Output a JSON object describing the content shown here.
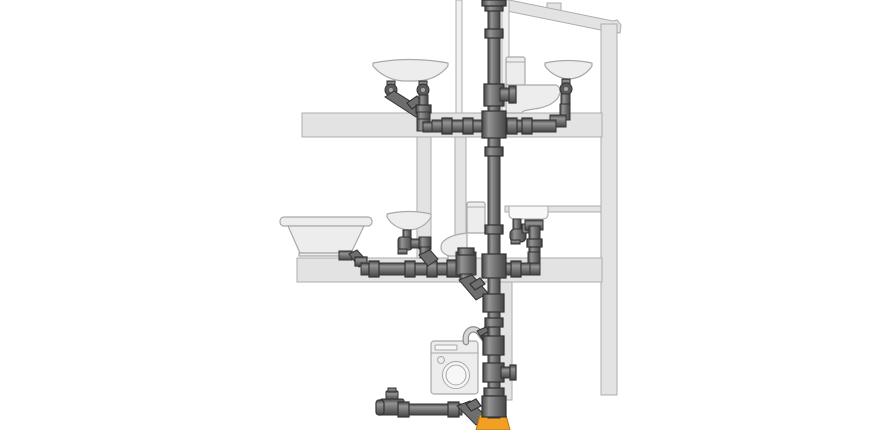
{
  "diagram": {
    "type": "building-drainage-cross-section",
    "floors": 3
  },
  "colors": {
    "background": "#ffffff",
    "structure": "#e3e3e3",
    "structure_stroke": "#aeaeae",
    "wall_light": "#f1f1f1",
    "fixture": "#ededed",
    "fixture_light": "#f7f7f7",
    "fixture_stroke": "#a9a9a9",
    "pipe_dark": "#474747",
    "pipe_mid": "#6e6e6e",
    "pipe_light": "#949494",
    "pipe_stroke": "#333333",
    "joint": "#5a5a5a",
    "joint_highlight": "#a6a6a6",
    "hose": "#d6d6d6",
    "hose_outline": "#8f8f8f",
    "sewer_orange": "#f2a024"
  },
  "labels": {
    "diagram": "Drainage system cross-section of a building",
    "roof": "Sloped roof",
    "right_wall": "Exterior wall",
    "upper_slab": "Upper floor slab",
    "middle_slab": "Lower floor slab",
    "attic_partition": "Attic partition wall",
    "attic_shaft": "Attic pipe shaft wall",
    "bathroom_wall": "Bathroom partition wall",
    "toilet_wall": "Toilet partition wall",
    "lower_shaft": "Ground floor pipe shaft wall",
    "stack": "Main soil and vent stack",
    "vent": "Roof vent collar",
    "attic_basin": "Wash basin with twin outlets (attic)",
    "attic_toilet": "Toilet (attic)",
    "attic_basin_right": "Wash basin (attic, right)",
    "attic_branch_left": "Attic branch pipe, left",
    "attic_branch_right": "Attic branch pipe, right",
    "attic_toilet_branch": "Attic toilet connection",
    "bathtub": "Bathtub",
    "basin": "Wash basin with trap",
    "toilet": "Toilet",
    "kitchen_sink": "Kitchen sink with trap",
    "floor_branch_left": "Floor branch pipe, left",
    "floor_branch_right": "Kitchen sink branch pipe",
    "toilet_drop": "Toilet drop into stack",
    "washing_machine": "Washing machine",
    "hose": "Washing machine drain hose",
    "washer_branch": "Washing machine branch fitting",
    "cleanout_branch": "Cleanout access fitting",
    "basement_branch": "Basement branch pipe with end cleanout",
    "sewer_bell": "Underground sewer pipe socket (orange)"
  }
}
